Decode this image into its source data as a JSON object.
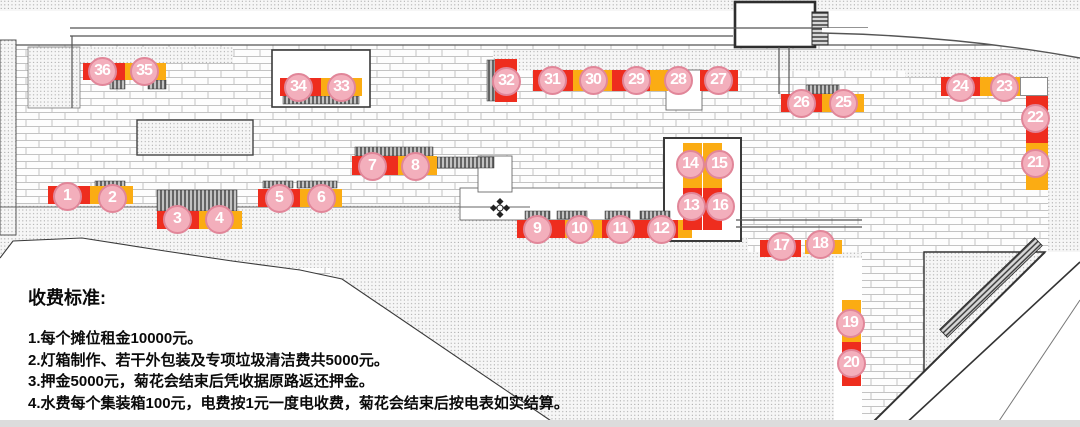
{
  "colors": {
    "red": "#ee2d1e",
    "yellow": "#fbac13",
    "circle_fill": "#f3afbc",
    "circle_border": "#e18699",
    "text": "#0a0a0a"
  },
  "fee_notice": {
    "heading": "收费标准:",
    "items": [
      "1.每个摊位租金10000元。",
      "2.灯箱制作、若干外包装及专项垃圾清洁费共5000元。",
      "3.押金5000元，菊花会结束后凭收据原路返还押金。",
      "4.水费每个集装箱100元，电费按1元一度电收费，菊花会结束后按电表如实结算。"
    ]
  },
  "map": {
    "stalls": [
      {
        "num": "1",
        "cx": 67,
        "cy": 196
      },
      {
        "num": "2",
        "cx": 112,
        "cy": 198
      },
      {
        "num": "3",
        "cx": 177,
        "cy": 219
      },
      {
        "num": "4",
        "cx": 219,
        "cy": 219
      },
      {
        "num": "5",
        "cx": 279,
        "cy": 198
      },
      {
        "num": "6",
        "cx": 321,
        "cy": 198
      },
      {
        "num": "7",
        "cx": 372,
        "cy": 166
      },
      {
        "num": "8",
        "cx": 415,
        "cy": 166
      },
      {
        "num": "9",
        "cx": 537,
        "cy": 229
      },
      {
        "num": "10",
        "cx": 579,
        "cy": 229
      },
      {
        "num": "11",
        "cx": 620,
        "cy": 229
      },
      {
        "num": "12",
        "cx": 661,
        "cy": 229
      },
      {
        "num": "13",
        "cx": 691,
        "cy": 206
      },
      {
        "num": "14",
        "cx": 690,
        "cy": 164
      },
      {
        "num": "15",
        "cx": 719,
        "cy": 164
      },
      {
        "num": "16",
        "cx": 720,
        "cy": 206
      },
      {
        "num": "17",
        "cx": 781,
        "cy": 246
      },
      {
        "num": "18",
        "cx": 820,
        "cy": 244
      },
      {
        "num": "19",
        "cx": 850,
        "cy": 323
      },
      {
        "num": "20",
        "cx": 851,
        "cy": 363
      },
      {
        "num": "21",
        "cx": 1035,
        "cy": 163
      },
      {
        "num": "22",
        "cx": 1035,
        "cy": 118
      },
      {
        "num": "23",
        "cx": 1004,
        "cy": 87
      },
      {
        "num": "24",
        "cx": 960,
        "cy": 87
      },
      {
        "num": "25",
        "cx": 843,
        "cy": 103
      },
      {
        "num": "26",
        "cx": 801,
        "cy": 103
      },
      {
        "num": "27",
        "cx": 718,
        "cy": 80
      },
      {
        "num": "28",
        "cx": 678,
        "cy": 80
      },
      {
        "num": "29",
        "cx": 636,
        "cy": 80
      },
      {
        "num": "30",
        "cx": 593,
        "cy": 80
      },
      {
        "num": "31",
        "cx": 552,
        "cy": 80
      },
      {
        "num": "32",
        "cx": 506,
        "cy": 81
      },
      {
        "num": "33",
        "cx": 341,
        "cy": 87
      },
      {
        "num": "34",
        "cx": 298,
        "cy": 87
      },
      {
        "num": "35",
        "cx": 144,
        "cy": 71
      },
      {
        "num": "36",
        "cx": 102,
        "cy": 71
      }
    ],
    "stall_bars": [
      {
        "x": 83,
        "y": 63,
        "w": 42,
        "h": 17,
        "color": "red"
      },
      {
        "x": 125,
        "y": 63,
        "w": 41,
        "h": 17,
        "color": "yellow"
      },
      {
        "x": 280,
        "y": 78,
        "w": 41,
        "h": 18,
        "color": "red"
      },
      {
        "x": 321,
        "y": 78,
        "w": 41,
        "h": 18,
        "color": "yellow"
      },
      {
        "x": 48,
        "y": 186,
        "w": 42,
        "h": 18,
        "color": "red"
      },
      {
        "x": 90,
        "y": 186,
        "w": 43,
        "h": 18,
        "color": "yellow"
      },
      {
        "x": 157,
        "y": 211,
        "w": 42,
        "h": 18,
        "color": "red"
      },
      {
        "x": 199,
        "y": 211,
        "w": 43,
        "h": 18,
        "color": "yellow"
      },
      {
        "x": 258,
        "y": 189,
        "w": 42,
        "h": 18,
        "color": "red"
      },
      {
        "x": 300,
        "y": 189,
        "w": 42,
        "h": 18,
        "color": "yellow"
      },
      {
        "x": 352,
        "y": 156,
        "w": 46,
        "h": 19,
        "color": "red"
      },
      {
        "x": 398,
        "y": 156,
        "w": 39,
        "h": 19,
        "color": "yellow"
      },
      {
        "x": 517,
        "y": 220,
        "w": 48,
        "h": 18,
        "color": "red"
      },
      {
        "x": 565,
        "y": 220,
        "w": 37,
        "h": 18,
        "color": "yellow"
      },
      {
        "x": 602,
        "y": 220,
        "w": 43,
        "h": 18,
        "color": "red"
      },
      {
        "x": 645,
        "y": 220,
        "w": 33,
        "h": 18,
        "color": "red"
      },
      {
        "x": 678,
        "y": 220,
        "w": 14,
        "h": 18,
        "color": "yellow"
      },
      {
        "x": 781,
        "y": 94,
        "w": 41,
        "h": 18,
        "color": "red"
      },
      {
        "x": 822,
        "y": 94,
        "w": 42,
        "h": 18,
        "color": "yellow"
      },
      {
        "x": 533,
        "y": 70,
        "w": 40,
        "h": 21,
        "color": "red"
      },
      {
        "x": 573,
        "y": 70,
        "w": 39,
        "h": 21,
        "color": "yellow"
      },
      {
        "x": 612,
        "y": 70,
        "w": 38,
        "h": 21,
        "color": "red"
      },
      {
        "x": 650,
        "y": 70,
        "w": 18,
        "h": 21,
        "color": "yellow"
      },
      {
        "x": 700,
        "y": 70,
        "w": 38,
        "h": 21,
        "color": "red"
      },
      {
        "x": 495,
        "y": 59,
        "w": 22,
        "h": 43,
        "color": "red"
      },
      {
        "x": 941,
        "y": 77,
        "w": 39,
        "h": 19,
        "color": "red"
      },
      {
        "x": 980,
        "y": 77,
        "w": 40,
        "h": 19,
        "color": "yellow"
      },
      {
        "x": 1020,
        "y": 77,
        "w": 28,
        "h": 19,
        "color": "white"
      },
      {
        "x": 1026,
        "y": 96,
        "w": 22,
        "h": 47,
        "color": "red"
      },
      {
        "x": 1026,
        "y": 143,
        "w": 22,
        "h": 47,
        "color": "yellow"
      },
      {
        "x": 683,
        "y": 143,
        "w": 19,
        "h": 45,
        "color": "yellow"
      },
      {
        "x": 703,
        "y": 143,
        "w": 19,
        "h": 45,
        "color": "yellow"
      },
      {
        "x": 683,
        "y": 188,
        "w": 19,
        "h": 42,
        "color": "red"
      },
      {
        "x": 703,
        "y": 188,
        "w": 19,
        "h": 42,
        "color": "red"
      },
      {
        "x": 760,
        "y": 240,
        "w": 41,
        "h": 17,
        "color": "red"
      },
      {
        "x": 805,
        "y": 240,
        "w": 37,
        "h": 14,
        "color": "yellow"
      },
      {
        "x": 842,
        "y": 300,
        "w": 19,
        "h": 42,
        "color": "yellow"
      },
      {
        "x": 842,
        "y": 342,
        "w": 19,
        "h": 44,
        "color": "red"
      }
    ]
  }
}
